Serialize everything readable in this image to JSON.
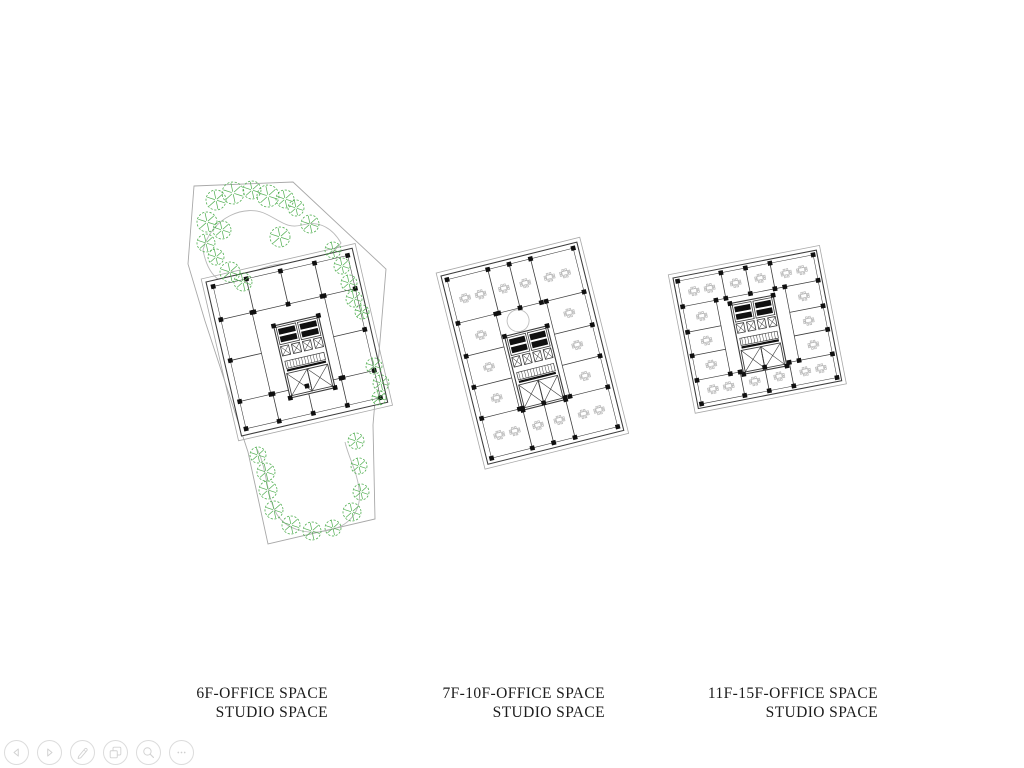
{
  "slide": {
    "plans": [
      {
        "name": "plan-6f",
        "title": "6F-OFFICE SPACE",
        "subtitle": "STUDIO SPACE"
      },
      {
        "name": "plan-7f-10f",
        "title": "7F-10F-OFFICE SPACE",
        "subtitle": "STUDIO SPACE"
      },
      {
        "name": "plan-11f-15f",
        "title": "11F-15F-OFFICE SPACE",
        "subtitle": "STUDIO SPACE"
      }
    ]
  },
  "toolbar": {
    "buttons": [
      {
        "label": "Previous slide",
        "icon": "chevron-left-icon"
      },
      {
        "label": "Next slide",
        "icon": "chevron-right-icon"
      },
      {
        "label": "Pen annotate",
        "icon": "pen-icon"
      },
      {
        "label": "Slide panel",
        "icon": "slides-icon"
      },
      {
        "label": "Magnifier",
        "icon": "magnifier-icon"
      },
      {
        "label": "More options",
        "icon": "ellipsis-icon"
      }
    ]
  },
  "colors": {
    "background": "#ffffff",
    "tree": "#4fae4f",
    "wall": "#3c3c3c",
    "dark": "#101010",
    "site": "#a8a8a8",
    "soft": "#b8b8b8",
    "label_text": "#1c1c1c",
    "toolbar_stroke": "#d6d6d6"
  }
}
